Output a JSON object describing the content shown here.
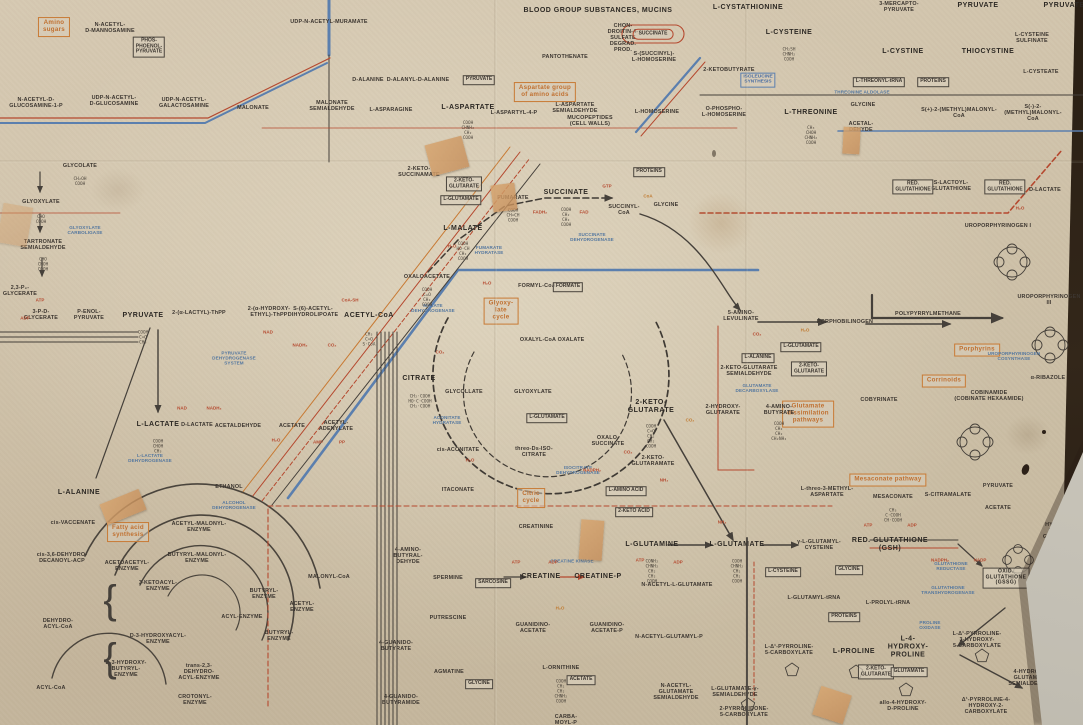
{
  "figure": {
    "kind": "biochemical pathways wall chart (detail)"
  },
  "palette": {
    "paper": "#d1c4ac",
    "black": "#3c3630",
    "red": "#b5492f",
    "blue": "#5b7fae",
    "orange": "#c87a34",
    "table": "#2a1f13"
  },
  "pathway_group_labels": [
    {
      "t": "Amino\nsugars",
      "x": 54,
      "y": 27
    },
    {
      "t": "Aspartate group\nof amino acids",
      "x": 545,
      "y": 92
    },
    {
      "t": "Glyoxy-\nlate\ncycle",
      "x": 501,
      "y": 311
    },
    {
      "t": "Citric\ncycle",
      "x": 531,
      "y": 498
    },
    {
      "t": "Fatty acid\nsynthesis",
      "x": 128,
      "y": 532
    },
    {
      "t": "Glutamate\ndissimilation\npathways",
      "x": 808,
      "y": 414
    },
    {
      "t": "Mesaconate pathway",
      "x": 888,
      "y": 480
    },
    {
      "t": "Porphyrins",
      "x": 977,
      "y": 350
    },
    {
      "t": "Corrinoids",
      "x": 944,
      "y": 381
    }
  ],
  "major_metabolites": [
    {
      "t": "PYRUVATE",
      "x": 143,
      "y": 316
    },
    {
      "t": "ACETYL-CoA",
      "x": 369,
      "y": 316
    },
    {
      "t": "L-MALATE",
      "x": 463,
      "y": 229
    },
    {
      "t": "SUCCINATE",
      "x": 566,
      "y": 193
    },
    {
      "t": "CITRATE",
      "x": 419,
      "y": 379
    },
    {
      "t": "2-KETO-\nGLUTARATE",
      "x": 651,
      "y": 407
    },
    {
      "t": "L-ASPARTATE",
      "x": 468,
      "y": 108
    },
    {
      "t": "BLOOD GROUP SUBSTANCES, MUCINS",
      "x": 598,
      "y": 11
    },
    {
      "t": "L-CYSTATHIONINE",
      "x": 748,
      "y": 8
    },
    {
      "t": "L-CYSTEINE",
      "x": 789,
      "y": 33
    },
    {
      "t": "L-CYSTINE",
      "x": 903,
      "y": 52
    },
    {
      "t": "THIOCYSTINE",
      "x": 988,
      "y": 52
    },
    {
      "t": "PYRUVATE",
      "x": 978,
      "y": 6
    },
    {
      "t": "PYRUVATE",
      "x": 1064,
      "y": 6
    },
    {
      "t": "L-THREONINE",
      "x": 811,
      "y": 113
    },
    {
      "t": "L-ALANINE",
      "x": 79,
      "y": 493
    },
    {
      "t": "L-LACTATE",
      "x": 158,
      "y": 425
    },
    {
      "t": "CREATINE",
      "x": 541,
      "y": 577
    },
    {
      "t": "CREATINE-P",
      "x": 598,
      "y": 577
    },
    {
      "t": "L-GLUTAMINE",
      "x": 652,
      "y": 545
    },
    {
      "t": "L-GLUTAMATE",
      "x": 737,
      "y": 545
    },
    {
      "t": "RED. GLUTATHIONE\n(GSH)",
      "x": 890,
      "y": 545
    },
    {
      "t": "L-PROLINE",
      "x": 854,
      "y": 652
    },
    {
      "t": "L-4-\nHYDROXY-\nPROLINE",
      "x": 908,
      "y": 647
    }
  ],
  "boxed_major": [
    {
      "t": "OXID.\nGLUTATHIONE\n(GSSG)",
      "x": 1006,
      "y": 578
    }
  ],
  "metabolites": [
    {
      "t": "N-ACETYL-\nD-MANNOSAMINE",
      "x": 110,
      "y": 28
    },
    {
      "t": "N-ACETYL-D-\nGLUCOSAMINE-1-P",
      "x": 36,
      "y": 103
    },
    {
      "t": "UDP-N-ACETYL-\nD-GLUCOSAMINE",
      "x": 114,
      "y": 101
    },
    {
      "t": "UDP-N-ACETYL-\nGALACTOSAMINE",
      "x": 184,
      "y": 103
    },
    {
      "t": "MALONATE",
      "x": 253,
      "y": 108
    },
    {
      "t": "MALONATE\nSEMIALDEHYDE",
      "x": 332,
      "y": 106
    },
    {
      "t": "UDP-N-ACETYL-MURAMATE",
      "x": 329,
      "y": 22
    },
    {
      "t": "MUCOPEPTIDES\n(CELL WALLS)",
      "x": 590,
      "y": 121
    },
    {
      "t": "D-ALANINE",
      "x": 368,
      "y": 80
    },
    {
      "t": "D-ALANYL-D-ALANINE",
      "x": 418,
      "y": 80
    },
    {
      "t": "L-ASPARAGINE",
      "x": 391,
      "y": 110
    },
    {
      "t": "L-ASPARTYL-4-P",
      "x": 514,
      "y": 113
    },
    {
      "t": "CHON-\nDROITIN-4-\nSULFATE\nDEGRAD.\nPROD.",
      "x": 623,
      "y": 38
    },
    {
      "t": "S-(SUCCINYL)-\nL-HOMOSERINE",
      "x": 654,
      "y": 57
    },
    {
      "t": "2-KETOBUTYRATE",
      "x": 729,
      "y": 70
    },
    {
      "t": "PANTOTHENATE",
      "x": 565,
      "y": 57
    },
    {
      "t": "L-HOMOSERINE",
      "x": 657,
      "y": 112
    },
    {
      "t": "O-PHOSPHO-\nL-HOMOSERINE",
      "x": 724,
      "y": 112
    },
    {
      "t": "L-ASPARTATE\nSEMIALDEHYDE",
      "x": 575,
      "y": 108
    },
    {
      "t": "3-MERCAPTO-\nPYRUVATE",
      "x": 899,
      "y": 7
    },
    {
      "t": "L-CYSTEINE SULFINATE",
      "x": 1032,
      "y": 38
    },
    {
      "t": "L-CYSTEATE",
      "x": 1041,
      "y": 72
    },
    {
      "t": "S(+)-2-(METHYL)MALONYL-\nCoA",
      "x": 959,
      "y": 113
    },
    {
      "t": "S(-)-2-(METHYL)MALONYL-\nCoA",
      "x": 1033,
      "y": 113
    },
    {
      "t": "GLYCINE",
      "x": 863,
      "y": 105
    },
    {
      "t": "ACETAL-\nDEHYDE",
      "x": 861,
      "y": 127
    },
    {
      "t": "GLYCOLATE",
      "x": 80,
      "y": 166
    },
    {
      "t": "GLYOXYLATE",
      "x": 41,
      "y": 202
    },
    {
      "t": "TARTRONATE\nSEMIALDEHYDE",
      "x": 43,
      "y": 245
    },
    {
      "t": "2,3-P₂-\nGLYCERATE",
      "x": 20,
      "y": 291
    },
    {
      "t": "3-P-D-\nGLYCERATE",
      "x": 41,
      "y": 315
    },
    {
      "t": "P-ENOL-\nPYRUVATE",
      "x": 89,
      "y": 315
    },
    {
      "t": "2-(α-LACTYL)-ThPP",
      "x": 199,
      "y": 313
    },
    {
      "t": "2-(α-HYDROXY-\nETHYL)-ThPP",
      "x": 269,
      "y": 312
    },
    {
      "t": "S-(6)-ACETYL-\nDIHYDROLIPOATE",
      "x": 313,
      "y": 312
    },
    {
      "t": "D-LACTATE",
      "x": 197,
      "y": 425
    },
    {
      "t": "ACETALDEHYDE",
      "x": 238,
      "y": 426
    },
    {
      "t": "ACETATE",
      "x": 292,
      "y": 426
    },
    {
      "t": "ACETYL-\nADENYLATE",
      "x": 336,
      "y": 426
    },
    {
      "t": "ETHANOL",
      "x": 229,
      "y": 487
    },
    {
      "t": "2-KETO-\nSUCCINAMATE",
      "x": 419,
      "y": 172
    },
    {
      "t": "FUMARATE",
      "x": 513,
      "y": 198
    },
    {
      "t": "SUCCINYL-\nCoA",
      "x": 624,
      "y": 210
    },
    {
      "t": "OXALOACETATE",
      "x": 427,
      "y": 277
    },
    {
      "t": "GLYCINE",
      "x": 666,
      "y": 205
    },
    {
      "t": "FORMYL-CoA",
      "x": 537,
      "y": 286
    },
    {
      "t": "OXALYL-CoA",
      "x": 538,
      "y": 340
    },
    {
      "t": "OXALATE",
      "x": 571,
      "y": 340
    },
    {
      "t": "GLYCOLLATE",
      "x": 464,
      "y": 392
    },
    {
      "t": "GLYOXYLATE",
      "x": 533,
      "y": 392
    },
    {
      "t": "cis-ACONITATE",
      "x": 458,
      "y": 450
    },
    {
      "t": "threo-Ds-ISO-\nCITRATE",
      "x": 534,
      "y": 452
    },
    {
      "t": "OXALO-\nSUCCINATE",
      "x": 608,
      "y": 441
    },
    {
      "t": "2-KETO-\nGLUTARAMATE",
      "x": 653,
      "y": 461
    },
    {
      "t": "ITACONATE",
      "x": 458,
      "y": 490
    },
    {
      "t": "5-AMINO-\nLEVULINATE",
      "x": 741,
      "y": 316
    },
    {
      "t": "PORPHOBILINOGEN",
      "x": 845,
      "y": 322
    },
    {
      "t": "POLYPYRRYLMETHANE",
      "x": 928,
      "y": 314
    },
    {
      "t": "2-KETO-GLUTARATE\nSEMIALDEHYDE",
      "x": 749,
      "y": 371
    },
    {
      "t": "2-HYDROXY-\nGLUTARATE",
      "x": 723,
      "y": 410
    },
    {
      "t": "4-AMINO-\nBUTYRATE",
      "x": 779,
      "y": 410
    },
    {
      "t": "COBYRINATE",
      "x": 879,
      "y": 400
    },
    {
      "t": "UROPORPHYRINOGEN I",
      "x": 998,
      "y": 226
    },
    {
      "t": "UROPORPHYRINOGEN III",
      "x": 1049,
      "y": 300
    },
    {
      "t": "S-LACTOYL-\nGLUTATHIONE",
      "x": 951,
      "y": 186
    },
    {
      "t": "D-LACTATE",
      "x": 1045,
      "y": 190
    },
    {
      "t": "COBINAMIDE\n(COBINATE HEXAAMIDE)",
      "x": 989,
      "y": 396
    },
    {
      "t": "α-RIBAZOLE",
      "x": 1048,
      "y": 378
    },
    {
      "t": "PYRUVATE",
      "x": 998,
      "y": 486
    },
    {
      "t": "ACETATE",
      "x": 998,
      "y": 508
    },
    {
      "t": "S-CITRAMALATE",
      "x": 948,
      "y": 495
    },
    {
      "t": "MESACONATE",
      "x": 893,
      "y": 497
    },
    {
      "t": "L-threo-3-METHYL-\nASPARTATE",
      "x": 827,
      "y": 492
    },
    {
      "t": "cis-VACCENATE",
      "x": 73,
      "y": 523
    },
    {
      "t": "cis-3,6-DEHYDRO-\nDECANOYL-ACP",
      "x": 62,
      "y": 558
    },
    {
      "t": "ACETYL-MALONYL-\nENZYME",
      "x": 199,
      "y": 527
    },
    {
      "t": "BUTYRYL-MALONYL-\nENZYME",
      "x": 197,
      "y": 558
    },
    {
      "t": "ACETOACETYL-\nENZYME",
      "x": 127,
      "y": 566
    },
    {
      "t": "3-KETOACYL-\nENZYME",
      "x": 158,
      "y": 586
    },
    {
      "t": "BUTYRYL-\nENZYME",
      "x": 264,
      "y": 594
    },
    {
      "t": "ACYL-ENZYME",
      "x": 242,
      "y": 617
    },
    {
      "t": "ACETYL-\nENZYME",
      "x": 302,
      "y": 607
    },
    {
      "t": "BUTYRYL-\nENZYME",
      "x": 279,
      "y": 636
    },
    {
      "t": "D-3-HYDROXYACYL-\nENZYME",
      "x": 158,
      "y": 639
    },
    {
      "t": "D-3-HYDROXY-\nBUTYRYL-\nENZYME",
      "x": 126,
      "y": 669
    },
    {
      "t": "trans-2,3-\nDEHYDRO-\nACYL-ENZYME",
      "x": 199,
      "y": 672
    },
    {
      "t": "CROTONYL-\nENZYME",
      "x": 195,
      "y": 700
    },
    {
      "t": "DEHYDRO-\nACYL-CoA",
      "x": 58,
      "y": 624
    },
    {
      "t": "ACYL-CoA",
      "x": 51,
      "y": 688
    },
    {
      "t": "MALONYL-CoA",
      "x": 329,
      "y": 577
    },
    {
      "t": "CREATININE",
      "x": 536,
      "y": 527
    },
    {
      "t": "4-AMINO-\nBUTYRAL-\nDEHYDE",
      "x": 408,
      "y": 556
    },
    {
      "t": "SPERMINE",
      "x": 448,
      "y": 578
    },
    {
      "t": "PUTRESCINE",
      "x": 448,
      "y": 618
    },
    {
      "t": "GUANIDINO-\nACETATE",
      "x": 533,
      "y": 628
    },
    {
      "t": "GUANIDINO-\nACETATE-P",
      "x": 607,
      "y": 628
    },
    {
      "t": "4-GUANIDO-\nBUTYRATE",
      "x": 396,
      "y": 646
    },
    {
      "t": "AGMATINE",
      "x": 449,
      "y": 672
    },
    {
      "t": "4-GUANIDO-\nBUTYRAMIDE",
      "x": 401,
      "y": 700
    },
    {
      "t": "L-ORNITHINE",
      "x": 561,
      "y": 668
    },
    {
      "t": "CARBA-\nMOYL-P",
      "x": 566,
      "y": 720
    },
    {
      "t": "γ-L-GLUTAMYL-\nCYSTEINE",
      "x": 819,
      "y": 545
    },
    {
      "t": "N-ACETYL-L-GLUTAMATE",
      "x": 677,
      "y": 585
    },
    {
      "t": "N-ACETYL-GLUTAMYL-P",
      "x": 669,
      "y": 637
    },
    {
      "t": "N-ACETYL-\nGLUTAMATE\nSEMIALDEHYDE",
      "x": 676,
      "y": 692
    },
    {
      "t": "L-GLUTAMATE-γ-\nSEMIALDEHYDE",
      "x": 735,
      "y": 692
    },
    {
      "t": "L-GLUTAMYL-tRNA",
      "x": 814,
      "y": 598
    },
    {
      "t": "L-Δ¹-PYRROLINE-\n5-CARBOXYLATE",
      "x": 789,
      "y": 650
    },
    {
      "t": "2-PYRROLIDONE-\n5-CARBOXYLATE",
      "x": 744,
      "y": 712
    },
    {
      "t": "L-PROLYL-tRNA",
      "x": 888,
      "y": 603
    },
    {
      "t": "L-Δ¹-PYRROLINE-\n3-HYDROXY-\n5-CARBOXYLATE",
      "x": 977,
      "y": 640
    },
    {
      "t": "4-HYDROXY-\nGLUTAMATE\nSEMIALDEHYDE",
      "x": 1031,
      "y": 678
    },
    {
      "t": "L-erythro-4-\nHYDROXY-\nGLUTAMATE",
      "x": 1050,
      "y": 597
    },
    {
      "t": "4-HYDROXY-\n2-KETO-\nGLUTARATE",
      "x": 1060,
      "y": 528
    },
    {
      "t": "allo-4-HYDROXY-\nD-PROLINE",
      "x": 903,
      "y": 706
    },
    {
      "t": "Δ¹-PYRROLINE-4-\nHYDROXY-2-\nCARBOXYLATE",
      "x": 986,
      "y": 706
    }
  ],
  "boxed_metabolites": [
    {
      "t": "PHOS-\nPHOENOL-\nPYRUVATE",
      "x": 149,
      "y": 47
    },
    {
      "t": "PYRUVATE",
      "x": 479,
      "y": 80
    },
    {
      "t": "2-KETO-\nGLUTARATE",
      "x": 464,
      "y": 184
    },
    {
      "t": "L-GLUTAMATE",
      "x": 461,
      "y": 200
    },
    {
      "t": "PROTEINS",
      "x": 649,
      "y": 172
    },
    {
      "t": "FORMATE",
      "x": 568,
      "y": 287
    },
    {
      "t": "L-GLUTAMATE",
      "x": 547,
      "y": 418
    },
    {
      "t": "L-AMINO ACID",
      "x": 626,
      "y": 491
    },
    {
      "t": "2-KETO ACID",
      "x": 634,
      "y": 512
    },
    {
      "t": "L-THREONYL-tRNA",
      "x": 879,
      "y": 82
    },
    {
      "t": "PROTEINS",
      "x": 933,
      "y": 82
    },
    {
      "t": "RED.\nGLUTATHIONE",
      "x": 913,
      "y": 187
    },
    {
      "t": "RED.\nGLUTATHIONE",
      "x": 1005,
      "y": 187
    },
    {
      "t": "L-GLUTAMATE",
      "x": 801,
      "y": 347
    },
    {
      "t": "L-ALANINE",
      "x": 758,
      "y": 358
    },
    {
      "t": "2-KETO-\nGLUTARATE",
      "x": 809,
      "y": 369
    },
    {
      "t": "SARCOSINE",
      "x": 493,
      "y": 583
    },
    {
      "t": "GLYCINE",
      "x": 479,
      "y": 684
    },
    {
      "t": "ACETATE",
      "x": 581,
      "y": 680
    },
    {
      "t": "L-CYSTEINE",
      "x": 783,
      "y": 572
    },
    {
      "t": "GLYCINE",
      "x": 849,
      "y": 570
    },
    {
      "t": "PROTEINS",
      "x": 844,
      "y": 617
    },
    {
      "t": "2-KETO-\nGLUTARATE",
      "x": 876,
      "y": 672
    },
    {
      "t": "GLUTAMATE",
      "x": 909,
      "y": 672
    }
  ],
  "round_red_boxes": [
    {
      "t": "SUCCINATE",
      "x": 653,
      "y": 34
    }
  ],
  "blue_boxed": [
    {
      "t": "ISOLEUCINE\nSYNTHESIS",
      "x": 758,
      "y": 80
    }
  ],
  "enzymes": [
    {
      "t": "PYRUVATE\nDEHYDROGENASE\nSYSTEM",
      "x": 234,
      "y": 358
    },
    {
      "t": "L-LACTATE\nDEHYDROGENASE",
      "x": 150,
      "y": 458
    },
    {
      "t": "ALCOHOL\nDEHYDROGENASE",
      "x": 234,
      "y": 505
    },
    {
      "t": "MALATE\nDEHYDROGENASE",
      "x": 433,
      "y": 308
    },
    {
      "t": "FUMARATE\nHYDRATASE",
      "x": 489,
      "y": 250
    },
    {
      "t": "SUCCINATE\nDEHYDROGENASE",
      "x": 592,
      "y": 237
    },
    {
      "t": "ACONITATE\nHYDRATASE",
      "x": 447,
      "y": 420
    },
    {
      "t": "ISOCITRATE\nDEHYDROGENASE",
      "x": 578,
      "y": 470
    },
    {
      "t": "GLUTAMATE\nDECARBOXYLASE",
      "x": 757,
      "y": 388
    },
    {
      "t": "CREATINE KINASE",
      "x": 572,
      "y": 561
    },
    {
      "t": "GLUTATHIONE\nREDUCTASE",
      "x": 951,
      "y": 566
    },
    {
      "t": "GLUTATHIONE\nTRANSHYDROGENASE",
      "x": 948,
      "y": 590
    },
    {
      "t": "UROPORPHYRINOGEN\nCOSYNTHASE",
      "x": 1014,
      "y": 356
    },
    {
      "t": "THREONINE ALDOLASE",
      "x": 862,
      "y": 92
    },
    {
      "t": "GLYOXYLATE\nCARBOLIGASE",
      "x": 85,
      "y": 230
    },
    {
      "t": "PROLINE\nOXIDASE",
      "x": 930,
      "y": 625
    }
  ],
  "cofactors": [
    {
      "t": "CoA-SH",
      "x": 350,
      "y": 300
    },
    {
      "t": "NAD",
      "x": 268,
      "y": 332
    },
    {
      "t": "NADH₂",
      "x": 300,
      "y": 345
    },
    {
      "t": "CO₂",
      "x": 332,
      "y": 345
    },
    {
      "t": "H₂O",
      "x": 452,
      "y": 246
    },
    {
      "t": "FADH₂",
      "x": 540,
      "y": 212
    },
    {
      "t": "FAD",
      "x": 584,
      "y": 212
    },
    {
      "t": "GTP",
      "x": 607,
      "y": 186
    },
    {
      "t": "CoA",
      "x": 648,
      "y": 196,
      "c": "o"
    },
    {
      "t": "H₂O",
      "x": 487,
      "y": 283
    },
    {
      "t": "CO₂",
      "x": 440,
      "y": 352
    },
    {
      "t": "NADPH₂",
      "x": 592,
      "y": 470
    },
    {
      "t": "CO₂",
      "x": 628,
      "y": 452
    },
    {
      "t": "NH₃",
      "x": 664,
      "y": 480
    },
    {
      "t": "ATP",
      "x": 516,
      "y": 562
    },
    {
      "t": "ADP",
      "x": 553,
      "y": 562
    },
    {
      "t": "H₂O",
      "x": 560,
      "y": 608,
      "c": "o"
    },
    {
      "t": "ATP",
      "x": 40,
      "y": 300
    },
    {
      "t": "ADP",
      "x": 25,
      "y": 318
    },
    {
      "t": "NAD",
      "x": 182,
      "y": 408
    },
    {
      "t": "NADH₂",
      "x": 214,
      "y": 408
    },
    {
      "t": "H₂O",
      "x": 276,
      "y": 440
    },
    {
      "t": "AMP",
      "x": 318,
      "y": 442
    },
    {
      "t": "PP",
      "x": 342,
      "y": 442
    },
    {
      "t": "ATP",
      "x": 868,
      "y": 525
    },
    {
      "t": "ADP",
      "x": 912,
      "y": 525
    },
    {
      "t": "NADPH₂",
      "x": 940,
      "y": 560
    },
    {
      "t": "NADP",
      "x": 980,
      "y": 560
    },
    {
      "t": "CO₂",
      "x": 757,
      "y": 334
    },
    {
      "t": "H₂O",
      "x": 805,
      "y": 330,
      "c": "o"
    },
    {
      "t": "ATP",
      "x": 640,
      "y": 560
    },
    {
      "t": "ADP",
      "x": 678,
      "y": 562
    },
    {
      "t": "NH₃",
      "x": 722,
      "y": 522
    },
    {
      "t": "H₂O",
      "x": 470,
      "y": 460
    },
    {
      "t": "CO₂",
      "x": 690,
      "y": 420,
      "c": "o"
    },
    {
      "t": "H₂O",
      "x": 1020,
      "y": 208
    }
  ],
  "formulas": [
    {
      "t": "COOH\nCH₂\nCH₂\nCOOH",
      "x": 566,
      "y": 218
    },
    {
      "t": "COOH\nHO·CH\nCH₂\nCOOH",
      "x": 463,
      "y": 252
    },
    {
      "t": "CH₂·COOH\nHO·C·COOH\nCH₂·COOH",
      "x": 420,
      "y": 402
    },
    {
      "t": "COOH\nC=O\nCH₂\nCH₂\nCOOH",
      "x": 651,
      "y": 437
    },
    {
      "t": "COOH\nC=O\nCH₃",
      "x": 143,
      "y": 338
    },
    {
      "t": "CH₃\nC=O\nS·CoA",
      "x": 369,
      "y": 340
    },
    {
      "t": "COOH\nCHNH₂\nCH₂\nCOOH",
      "x": 468,
      "y": 131
    },
    {
      "t": "COOH\nCHNH₂\nCH₂\nCH₂\nCOOH",
      "x": 737,
      "y": 572
    },
    {
      "t": "CONH₂\nCHNH₂\nCH₂\nCH₂\nCOOH",
      "x": 652,
      "y": 572
    },
    {
      "t": "CH₂SH\nCHNH₂\nCOOH",
      "x": 789,
      "y": 55
    },
    {
      "t": "CH₃\nCHOH\nCHNH₂\nCOOH",
      "x": 811,
      "y": 136
    },
    {
      "t": "COOH\nCHOH\nCH₃",
      "x": 158,
      "y": 447
    },
    {
      "t": "CHO\nCOOH",
      "x": 41,
      "y": 220
    },
    {
      "t": "CH₂OH\nCOOH",
      "x": 80,
      "y": 182
    },
    {
      "t": "CHO\nCHOH\nCOOH",
      "x": 43,
      "y": 265
    },
    {
      "t": "COOH\nCH=CH\nCOOH",
      "x": 513,
      "y": 216
    },
    {
      "t": "COOH\nCH₂\nCH₂\nCH₂NH₂",
      "x": 779,
      "y": 432
    },
    {
      "t": "COOH\nCH₂\nCH₂\nCHNH₂\nCOOH",
      "x": 561,
      "y": 692
    },
    {
      "t": "CH₃\nC·COOH\nCH·COOH",
      "x": 893,
      "y": 516
    },
    {
      "t": "COOH\nC=O\nCH₂\nCOOH",
      "x": 427,
      "y": 298
    }
  ],
  "braces": [
    {
      "t": "{",
      "x": 110,
      "y": 600
    },
    {
      "t": "{",
      "x": 110,
      "y": 658
    }
  ]
}
